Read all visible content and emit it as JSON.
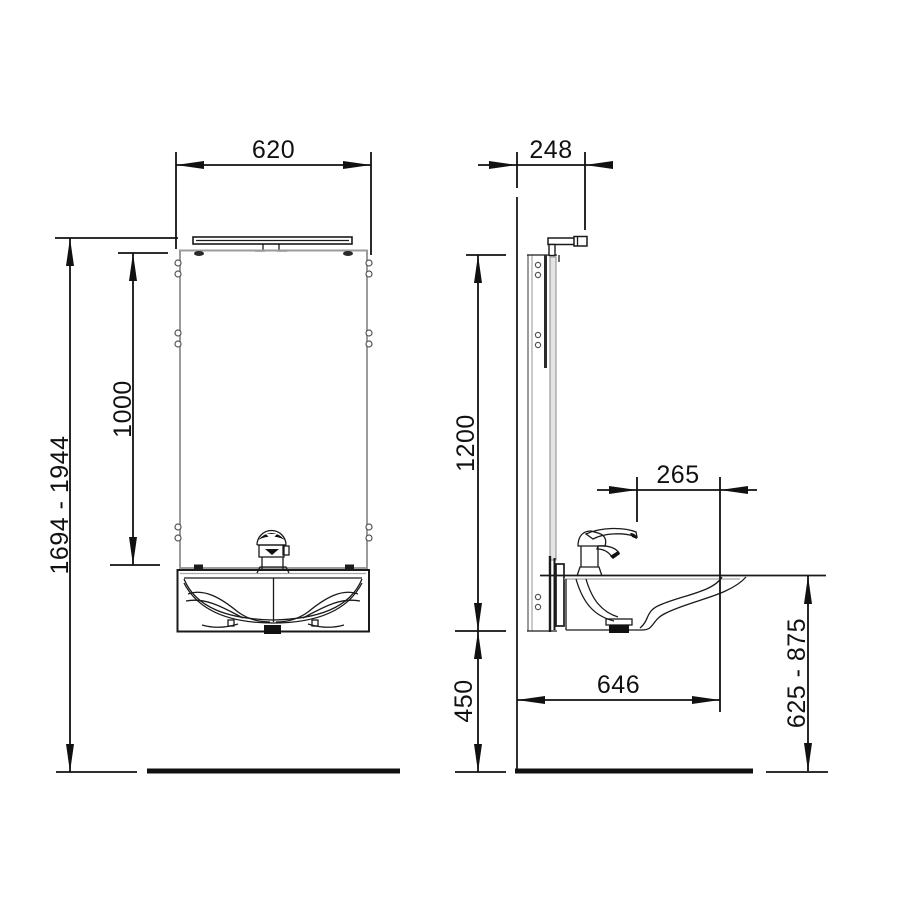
{
  "drawing": {
    "front_view": {
      "width_mm": "620",
      "mirror_height_mm": "1000",
      "overall_height_range_mm": "1694 - 1944"
    },
    "side_view": {
      "top_depth_mm": "248",
      "unit_height_mm": "1200",
      "basin_projection_mm": "265",
      "floor_clearance_mm": "450",
      "total_depth_mm": "646",
      "rim_height_range_mm": "625 - 875"
    },
    "colors": {
      "line": "#1a1a1a",
      "silver_detail": "#9b9b9b",
      "background": "#ffffff"
    }
  }
}
